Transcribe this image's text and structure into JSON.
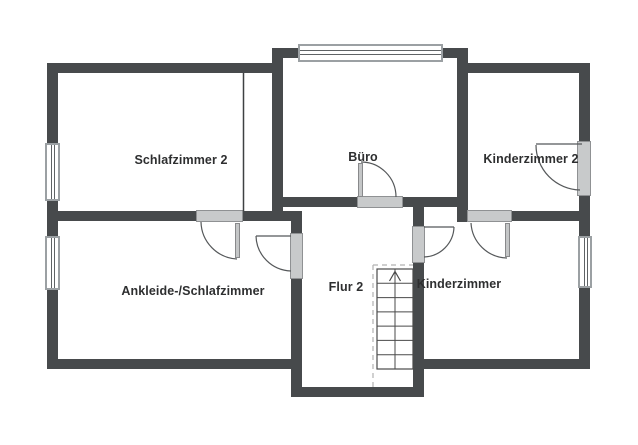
{
  "floorplan": {
    "title": "Obergeschoss Grundriss",
    "rooms": [
      {
        "label": "Schlafzimmer 2"
      },
      {
        "label": "Büro"
      },
      {
        "label": "Kinderzimmer 2"
      },
      {
        "label": "Ankleide-/Schlafzimmer"
      },
      {
        "label": "Flur 2"
      },
      {
        "label": "Kinderzimmer"
      }
    ],
    "stairs": {
      "location": "Flur 2",
      "direction_arrow": "up",
      "steps_visible": 7
    },
    "features": {
      "windows": [
        "Schlafzimmer 2 links",
        "Ankleide-/Schlafzimmer links",
        "Büro oben",
        "Kinderzimmer rechts"
      ],
      "doors": [
        "Büro–Flur 2",
        "Schlafzimmer 2–Ankleide",
        "Ankleide–Flur 2",
        "Flur 2–Kinderzimmer",
        "Kinderzimmer 2–Kinderzimmer",
        "Kinderzimmer 2 rechts"
      ]
    },
    "colors": {
      "wall": "#474a4c",
      "door_fill": "#c8cacb",
      "door_border": "#8f9193",
      "window_frame": "#9ba0a3",
      "line": "#4a4a4a",
      "dashed_line": "#b2b2b2",
      "text": "#2e2f30",
      "background": "#ffffff"
    }
  }
}
